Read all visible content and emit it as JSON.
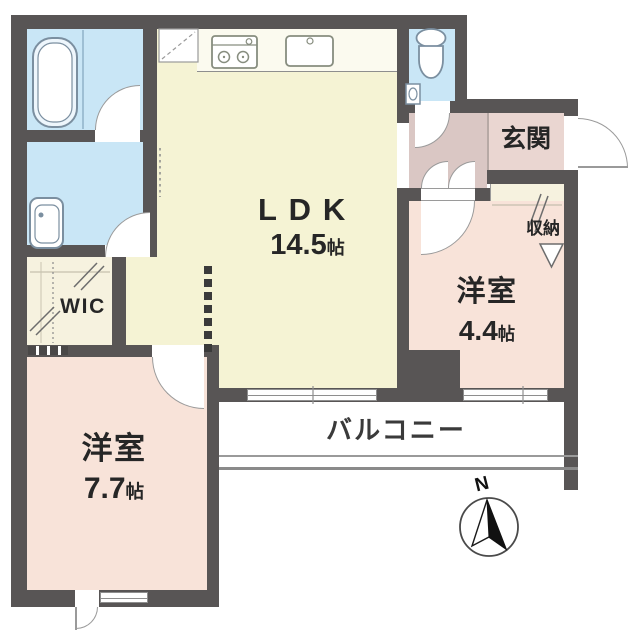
{
  "plan_title": "apartment-floor-plan",
  "rooms": {
    "ldk": {
      "name": "LDK",
      "size": "14.5",
      "unit": "帖"
    },
    "bedroom_large": {
      "name": "洋室",
      "size": "7.7",
      "unit": "帖"
    },
    "bedroom_small": {
      "name": "洋室",
      "size": "4.4",
      "unit": "帖"
    },
    "entrance": {
      "name": "玄関"
    },
    "balcony": {
      "name": "バルコニー"
    },
    "wic": {
      "name": "WIC"
    },
    "storage": {
      "name": "収納"
    }
  },
  "compass": {
    "label": "N"
  },
  "fixtures": [
    "bathtub",
    "washbasin",
    "toilet",
    "stove-two-burner",
    "kitchen-sink",
    "refrigerator-space"
  ],
  "colors": {
    "wall": "#585555",
    "ldk_floor": "#f5f3d4",
    "bedroom_floor": "#f8e3d9",
    "wet_area": "#c9e6f6",
    "hallway": "#dac7c4",
    "entrance_floor": "#ead6d1",
    "closet": "#f6f2df",
    "line": "#9a9a9a",
    "text": "#262626"
  }
}
